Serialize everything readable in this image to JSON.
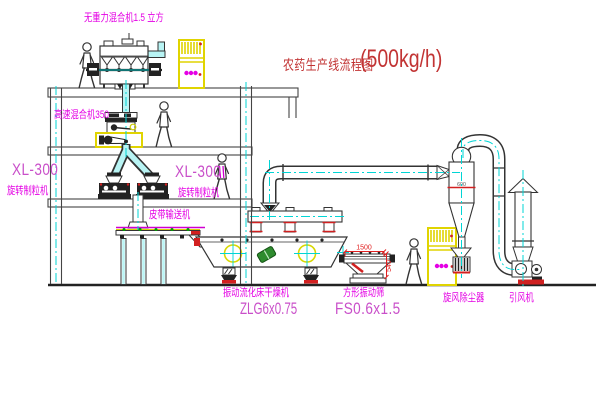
{
  "title": {
    "text_cn": "农药生产线流程图",
    "capacity": "(500kg/h)"
  },
  "labels": {
    "gravity_mixer": "无重力混合机1.5 立方",
    "high_speed_mixer": "高速混合机350",
    "granulator_left_model": "XL-300",
    "granulator_left_name": "旋转制粒机",
    "granulator_right_model": "XL-300",
    "granulator_right_name": "旋转制粒机",
    "belt_conveyor": "皮带输送机",
    "dryer_name": "振动流化床干燥机",
    "dryer_model": "ZLG6x0.75",
    "screen_name": "方形振动筛",
    "screen_model": "FS0.6x1.5",
    "cyclone_name": "旋风除尘器",
    "fan_name": "引风机"
  },
  "dimensions": {
    "screen_width": "1500",
    "screen_height": "540",
    "cyclone_band": "600"
  },
  "colors": {
    "label_magenta": "#e400e4",
    "model_pink": "#c94fc9",
    "title_red": "#c23434",
    "dim_red": "#e02020",
    "line_dark": "#333333",
    "centerline_cyan": "#00d5d5",
    "pipe_fill": "#b8f4f4",
    "cabinet_yellow": "#e0d400",
    "crosshair_yellow": "#d8d800",
    "drum_green": "#2e8b2e",
    "base_red": "#cf2020",
    "conveyor_green": "#00a000"
  }
}
